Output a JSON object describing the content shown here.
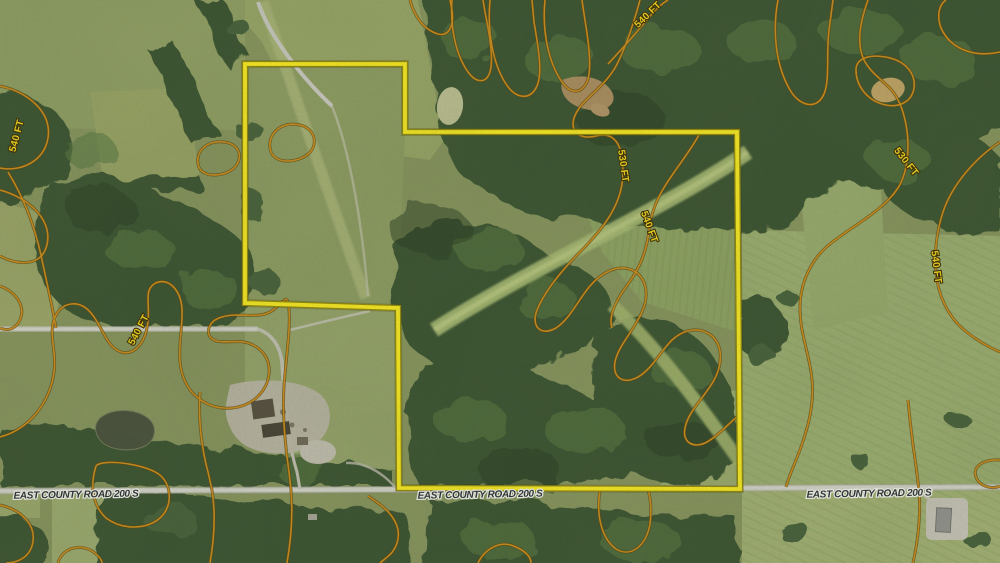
{
  "map": {
    "kind": "aerial-parcel-map",
    "colors": {
      "parcel": "#f8e922",
      "parcel_edge": "#93880c",
      "contour": "#cc8b1c",
      "contour_edge": "#5c430a",
      "contour_label": "#f2d51e",
      "road_label": "#2d3135",
      "road_label_halo": "#f4f4ee"
    },
    "parcel_boundary": {
      "points": "245,64 405,64 405,132 737,132 740,489 399,488 398,308 245,303"
    },
    "contour": {
      "unit": "FT",
      "labels": [
        {
          "text": "540 FT",
          "x": 648,
          "y": 15,
          "rotation": -44
        },
        {
          "text": "530 FT",
          "x": 623,
          "y": 166,
          "rotation": 82
        },
        {
          "text": "540 FT",
          "x": 649,
          "y": 227,
          "rotation": 70
        },
        {
          "text": "530 FT",
          "x": 906,
          "y": 162,
          "rotation": 52
        },
        {
          "text": "540 FT",
          "x": 936,
          "y": 267,
          "rotation": 83
        },
        {
          "text": "540 FT",
          "x": 17,
          "y": 136,
          "rotation": -75
        },
        {
          "text": "540 FT",
          "x": 139,
          "y": 330,
          "rotation": -62
        }
      ]
    },
    "road_labels": [
      {
        "text": "EAST COUNTY ROAD 200 S",
        "x": 76,
        "y": 495,
        "rotation": -1
      },
      {
        "text": "EAST COUNTY ROAD 200 S",
        "x": 480,
        "y": 495,
        "rotation": -1
      },
      {
        "text": "EAST COUNTY ROAD 200 S",
        "x": 869,
        "y": 494,
        "rotation": -1
      }
    ]
  }
}
